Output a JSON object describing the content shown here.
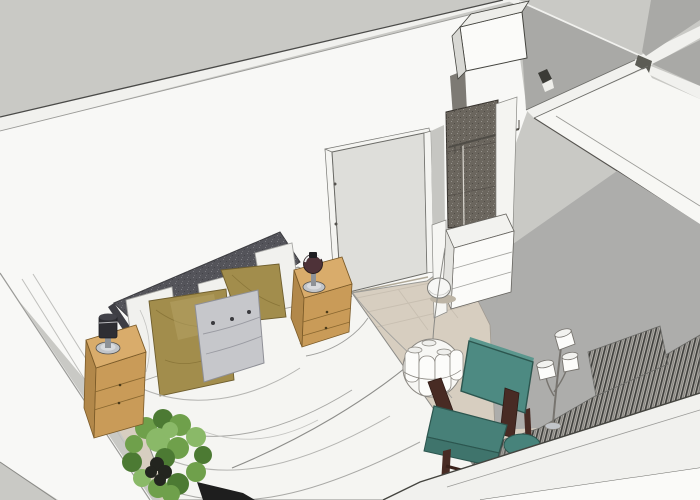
{
  "scene": {
    "type": "3d-interior-rendering",
    "room": "bedroom",
    "view": "overhead isometric, sketchup style, no visible text"
  },
  "palette": {
    "outside": "#c9c9c5",
    "wall": "#f8f8f6",
    "wall_band": "#f1f1ee",
    "wall_shadow": "#a9a9a6",
    "wall_plane": "#f7f7f4",
    "floor": "#d7cec0",
    "rug": "#adadab",
    "door": "#dededa",
    "door_frame": "#f4f4f1",
    "panel_dark": "#6b665e",
    "headboard": "#54545a",
    "headboard_edge": "#3e3e44",
    "bedding": "#f5f5f2",
    "pillow_white": "#f1f1ee",
    "pillow_olive": "#a28d4c",
    "pillow_gray": "#c6c7cb",
    "wood_top": "#d9ac6b",
    "wood_front": "#c99b58",
    "wood_side": "#b2884a",
    "chair_teal": "#4d8a82",
    "chair_teal_mid": "#478078",
    "chair_teal_dark": "#3f746c",
    "chair_wood": "#482b24",
    "pouf_teal": "#47837b",
    "shade_white": "#fcfcfa",
    "chest_white": "#fbfbf9",
    "box_white": "#fbfbf9",
    "metal": "#c2c5c9",
    "lamp_dark": "#2e2e33",
    "lamp_glass": "#4e3238",
    "plant_green": "#6fa04b",
    "plant_green_dark": "#4c7a33",
    "plant_green_light": "#8ab968",
    "plant_pot": "#23251f",
    "bench_dark": "#1e1e1e",
    "outer_face": "#fafaf8"
  },
  "objects": {
    "bed": "double bed, white duvet, dark gray upholstered headboard",
    "pillows": [
      "white pillow left",
      "white pillow right",
      "olive pillow left",
      "olive pillow right",
      "gray button accent pillow"
    ],
    "nightstands": "two light-wood nightstands with drawers and small table lamps",
    "plant": "leafy green plant at left bed corner",
    "armchair": "teal armchair with dark wood frame",
    "pouf": "teal round pouf",
    "pendant_lamp": "cluster pendant of white cylinders",
    "floor_lamp": "three-shade white floor lamp",
    "wardrobe": "niche with dark textured panel, hanging rail, white chest of drawers, round stool, overhead white box",
    "door": "light gray door in back wall",
    "curtain": "dark striped curtain along front wall",
    "walls": "white walls seen from above, adjacent rooms to the right"
  }
}
